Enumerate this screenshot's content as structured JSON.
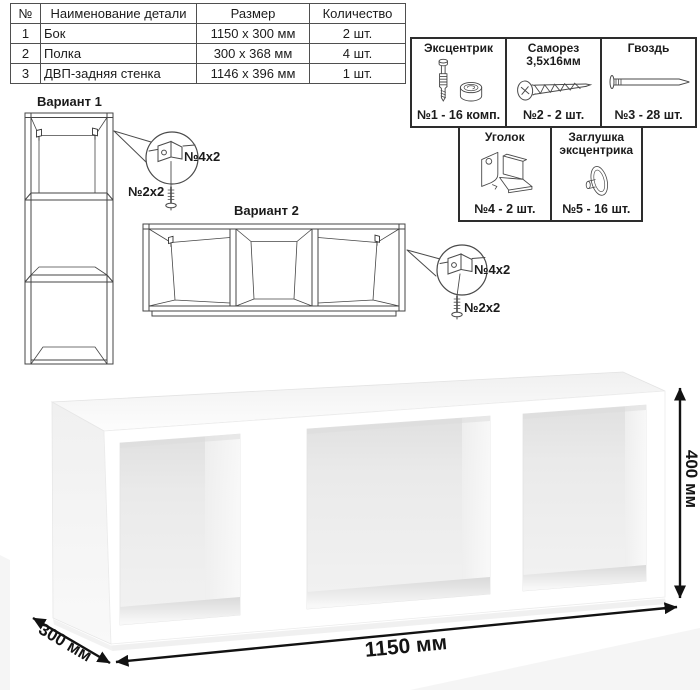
{
  "parts_table": {
    "headers": [
      "№",
      "Наименование детали",
      "Размер",
      "Количество"
    ],
    "rows": [
      {
        "num": "1",
        "name": "Бок",
        "size": "1150 x 300 мм",
        "qty": "2 шт."
      },
      {
        "num": "2",
        "name": "Полка",
        "size": "300 x 368 мм",
        "qty": "4 шт."
      },
      {
        "num": "3",
        "name": "ДВП-задняя стенка",
        "size": "1146 x 396 мм",
        "qty": "1 шт."
      }
    ]
  },
  "hardware": {
    "items": [
      {
        "title": "Эксцентрик",
        "count": "№1 - 16 комп.",
        "icon": "eccentric-cam-icon"
      },
      {
        "title": "Саморез 3,5х16мм",
        "count": "№2 - 2 шт.",
        "icon": "screw-icon"
      },
      {
        "title": "Гвоздь",
        "count": "№3 - 28 шт.",
        "icon": "nail-icon"
      },
      {
        "title": "Уголок",
        "count": "№4 - 2 шт.",
        "icon": "corner-bracket-icon"
      },
      {
        "title": "Заглушка эксцентрика",
        "count": "№5 - 16 шт.",
        "icon": "cam-cover-icon"
      }
    ]
  },
  "variants": {
    "variant1_label": "Вариант 1",
    "variant2_label": "Вариант 2"
  },
  "callouts": {
    "bracket_label": "№4х2",
    "screw_label": "№2х2"
  },
  "dimensions": {
    "width": "1150 мм",
    "depth": "300 мм",
    "height": "400 мм"
  },
  "colors": {
    "line_art": "#464646",
    "border_dark": "#2d2d2d",
    "dimension_arrow": "#121212",
    "render_shade": "#e8e8e8"
  }
}
